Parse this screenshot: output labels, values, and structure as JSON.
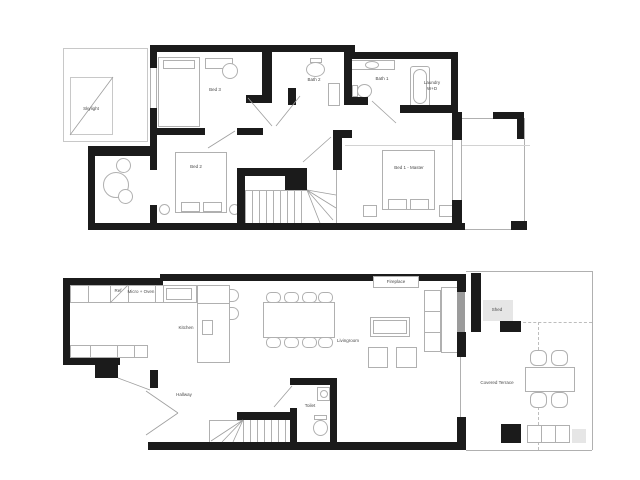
{
  "colors": {
    "wall": "#1b1b1b",
    "furniture_outline": "#b0b0b0",
    "label_text": "#4a4a4a",
    "shed_fill": "#e6e6e6",
    "glass_door": "#9b9b9b",
    "background": "#ffffff"
  },
  "upper": {
    "labels": {
      "skylight": "Skylight",
      "bed3": "Bed 3",
      "bath2": "Bath 2",
      "bath1": "Bath 1",
      "laundry_line1": "Laundry",
      "laundry_line2": "W+D",
      "bed2": "Bed 2",
      "bed1": "Bed 1 - Master"
    }
  },
  "lower": {
    "labels": {
      "ref": "Ref",
      "micro_oven": "Micro + Oven",
      "kitchen": "Kitchen",
      "fireplace": "Fireplace",
      "livingroom": "Livingroom",
      "hallway": "Hallway",
      "toilet": "Toilet",
      "shed": "Shed",
      "covered_terrace": "Covered Terrace"
    }
  }
}
